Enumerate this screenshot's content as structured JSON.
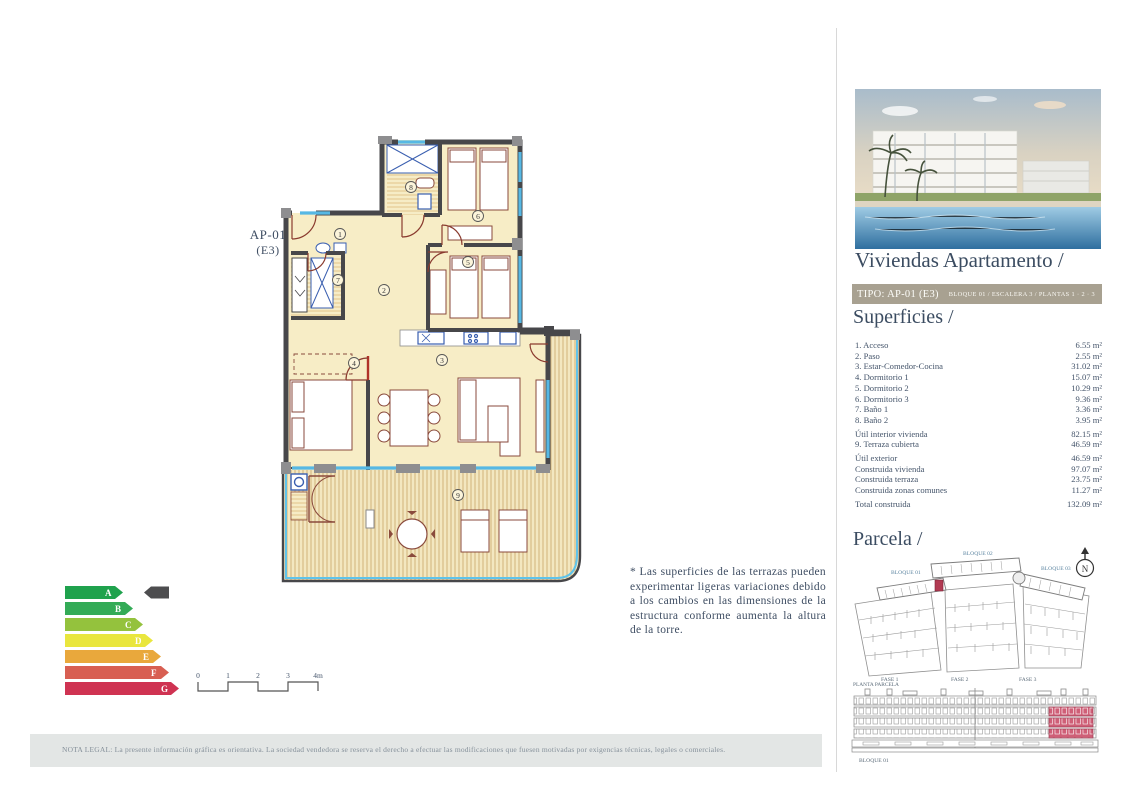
{
  "plan": {
    "unit_label": "AP-01",
    "unit_sub": "(E3)",
    "rooms": [
      {
        "num": "1"
      },
      {
        "num": "2"
      },
      {
        "num": "3"
      },
      {
        "num": "4"
      },
      {
        "num": "5"
      },
      {
        "num": "6"
      },
      {
        "num": "7"
      },
      {
        "num": "8"
      },
      {
        "num": "9"
      }
    ]
  },
  "note": {
    "text": "* Las superficies de las terrazas pueden experimentar ligeras variaciones debido a los cambios en las dimensiones de la estructura conforme aumenta la altura de la torre."
  },
  "energy": {
    "ratings": [
      {
        "letter": "A",
        "color": "#1fa24d"
      },
      {
        "letter": "B",
        "color": "#33ab57"
      },
      {
        "letter": "C",
        "color": "#94c23d"
      },
      {
        "letter": "D",
        "color": "#e9e63e"
      },
      {
        "letter": "E",
        "color": "#e9a83c"
      },
      {
        "letter": "F",
        "color": "#d85f52"
      },
      {
        "letter": "G",
        "color": "#cf3352"
      }
    ],
    "current": "A",
    "indicator_color": "#4d4d4f"
  },
  "scalebar": {
    "ticks": [
      "0",
      "1",
      "2",
      "3",
      "4m"
    ]
  },
  "legal": {
    "text": "NOTA LEGAL: La presente información gráfica es orientativa. La sociedad vendedora se reserva el derecho a efectuar las modificaciones que fuesen motivadas por exigencias técnicas, legales o comerciales."
  },
  "panel": {
    "title": "Viviendas Apartamento /",
    "type_band": {
      "type": "TIPO: AP-01 (E3)",
      "location": "BLOQUE 01  / ESCALERA 3 / PLANTAS 1 · 2 · 3"
    },
    "superficies": {
      "title": "Superficies /",
      "rows": [
        {
          "label": "1. Acceso",
          "value": "6.55 m²",
          "gap": false
        },
        {
          "label": "2. Paso",
          "value": "2.55 m²",
          "gap": false
        },
        {
          "label": "3. Estar-Comedor-Cocina",
          "value": "31.02 m²",
          "gap": false
        },
        {
          "label": "4. Dormitorio 1",
          "value": "15.07 m²",
          "gap": false
        },
        {
          "label": "5. Dormitorio 2",
          "value": "10.29 m²",
          "gap": false
        },
        {
          "label": "6. Dormitorio 3",
          "value": "9.36 m²",
          "gap": false
        },
        {
          "label": "7. Baño 1",
          "value": "3.36 m²",
          "gap": false
        },
        {
          "label": "8. Baño 2",
          "value": "3.95 m²",
          "gap": false
        },
        {
          "label": "Útil interior vivienda",
          "value": "82.15 m²",
          "gap": true
        },
        {
          "label": "9. Terraza cubierta",
          "value": "46.59 m²",
          "gap": false
        },
        {
          "label": "Útil exterior",
          "value": "46.59 m²",
          "gap": true
        },
        {
          "label": "Construida vivienda",
          "value": "97.07 m²",
          "gap": false
        },
        {
          "label": "Construida terraza",
          "value": "23.75 m²",
          "gap": false
        },
        {
          "label": "Construida zonas comunes",
          "value": "11.27 m²",
          "gap": false
        },
        {
          "label": "Total construida",
          "value": "132.09 m²",
          "gap": true
        }
      ]
    },
    "parcela": {
      "title": "Parcela /",
      "blocks": [
        "BLOQUE 01",
        "BLOQUE 02",
        "BLOQUE 03"
      ],
      "fases": [
        "FASE 1",
        "FASE 2",
        "FASE 3"
      ],
      "caption": "PLANTA PARCELA",
      "compass": "N",
      "highlight_color": "#b23a52"
    },
    "elevation": {
      "label": "BLOQUE 01",
      "highlight_color": "#cf5f77"
    }
  }
}
